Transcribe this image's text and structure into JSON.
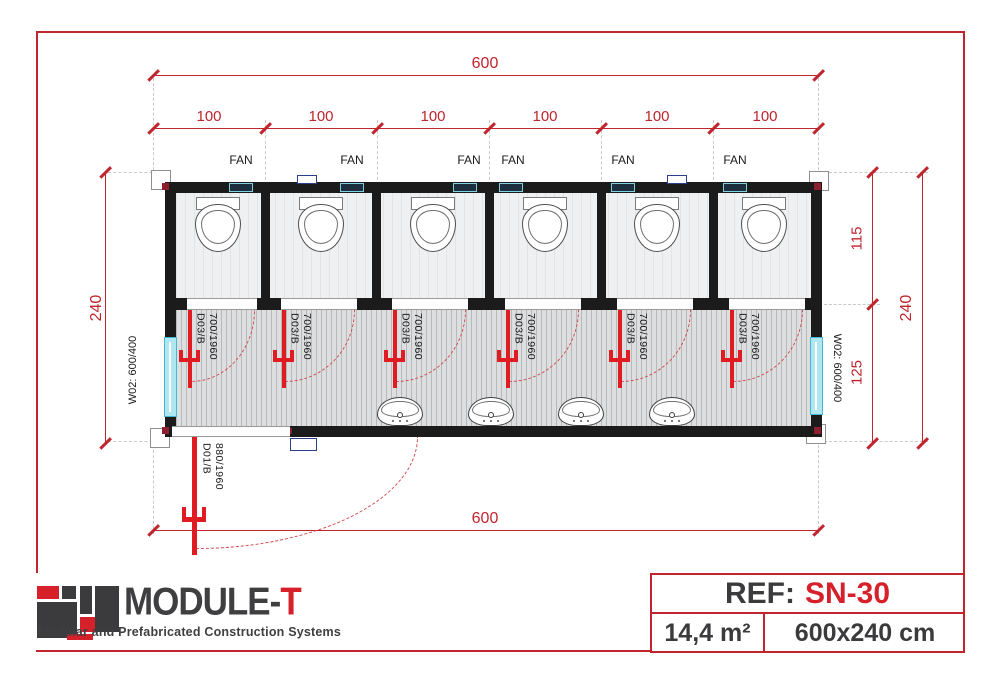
{
  "drawing": {
    "dimensions": {
      "top_total": "600",
      "top_segments": [
        "100",
        "100",
        "100",
        "100",
        "100",
        "100"
      ],
      "bottom_total": "600",
      "left_total": "240",
      "right_upper": "115",
      "right_lower": "125",
      "right_total": "240"
    },
    "labels": {
      "fan": "FAN"
    },
    "stall_doors": [
      {
        "code": "D03/B",
        "size": "700/1960"
      },
      {
        "code": "D03/B",
        "size": "700/1960"
      },
      {
        "code": "D03/B",
        "size": "700/1960"
      },
      {
        "code": "D03/B",
        "size": "700/1960"
      },
      {
        "code": "D03/B",
        "size": "700/1960"
      },
      {
        "code": "D03/B",
        "size": "700/1960"
      }
    ],
    "entrance_door": {
      "code": "D01/B",
      "size": "880/1960"
    },
    "windows": {
      "left": "W02: 600/400",
      "right": "W02: 600/400"
    }
  },
  "title_block": {
    "logo_main": "MODULE-",
    "logo_accent": "T",
    "tagline": "Modular and Prefabricated Construction Systems",
    "ref_label": "REF:",
    "ref_value": "SN-30",
    "area": "14,4 m²",
    "size": "600x240 cm"
  },
  "colors": {
    "dimension_red": "#c0242c",
    "door_red": "#e01b22",
    "accent_red": "#d6212b",
    "wall_black": "#1b1b1b",
    "window_cyan": "#aee7f2",
    "dark_gray": "#3f3f41"
  }
}
